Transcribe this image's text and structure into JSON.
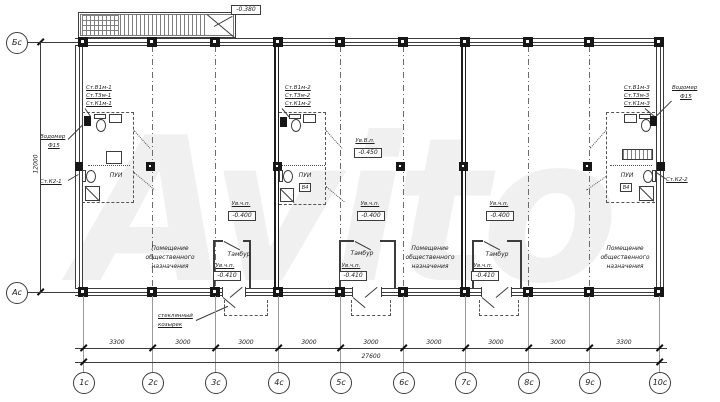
{
  "watermark": "Avito",
  "axes": {
    "bottom": [
      "1с",
      "2с",
      "3с",
      "4с",
      "5с",
      "6с",
      "7с",
      "8с",
      "9с",
      "10с"
    ],
    "left_top": "Бс",
    "left_bottom": "Ас"
  },
  "dims": {
    "segments": [
      "3300",
      "3000",
      "3000",
      "3000",
      "3000",
      "3000",
      "3000",
      "3000",
      "3300"
    ],
    "total": "27600",
    "height": "12000"
  },
  "elev": {
    "ramp": "-0.380",
    "vp_label": "Ув.В.п.",
    "vp": "-0.450",
    "fl_label": "Ув.ч.п.",
    "fl": "-0.400",
    "tam": "-0.410"
  },
  "rooms": {
    "public_lines": [
      "Помещение",
      "общественного",
      "назначения"
    ],
    "tambour": "Тамбур",
    "pui": "ПУИ",
    "vent": "В4"
  },
  "stacks": {
    "g1": [
      "Ст.В1м-1",
      "Ст.Т3м-1",
      "Ст.К1м-1"
    ],
    "g2": [
      "Ст.В1м-2",
      "Ст.Т3м-2",
      "Ст.К1м-2"
    ],
    "g3": [
      "Ст.В1м-3",
      "Ст.Т3м-3",
      "Ст.К1м-3"
    ],
    "k2_left": "Ст.К2-1",
    "k2_right": "Ст.К2-2"
  },
  "meter": {
    "l1": "Водомер",
    "l2": "Ф15"
  },
  "canopy": {
    "l1": "стеклянный",
    "l2": "козырек"
  }
}
